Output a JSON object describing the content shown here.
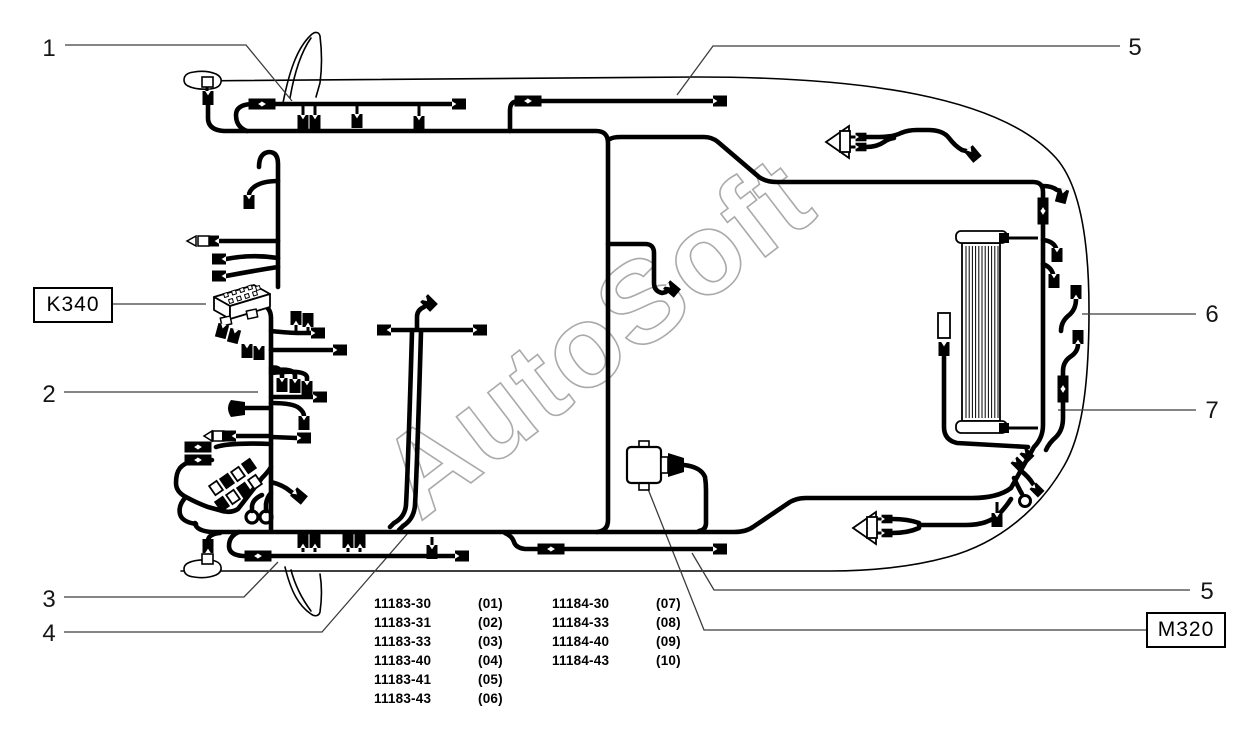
{
  "watermark": "AutoSoft",
  "callouts": {
    "n1": "1",
    "n2": "2",
    "n3": "3",
    "n4": "4",
    "n5_top": "5",
    "n5_bottom": "5",
    "n6": "6",
    "n7": "7"
  },
  "boxed_labels": {
    "k340": "K340",
    "m320": "M320"
  },
  "part_variants": {
    "left": [
      {
        "code": "11183-30",
        "num": "(01)"
      },
      {
        "code": "11183-31",
        "num": "(02)"
      },
      {
        "code": "11183-33",
        "num": "(03)"
      },
      {
        "code": "11183-40",
        "num": "(04)"
      },
      {
        "code": "11183-41",
        "num": "(05)"
      },
      {
        "code": "11183-43",
        "num": "(06)"
      }
    ],
    "right": [
      {
        "code": "11184-30",
        "num": "(07)"
      },
      {
        "code": "11184-33",
        "num": "(08)"
      },
      {
        "code": "11184-40",
        "num": "(09)"
      },
      {
        "code": "11184-43",
        "num": "(10)"
      }
    ]
  },
  "colors": {
    "line": "#000000",
    "leader": "#3c3c3c",
    "watermark_stroke": "#aaaaaa",
    "background": "#ffffff"
  }
}
